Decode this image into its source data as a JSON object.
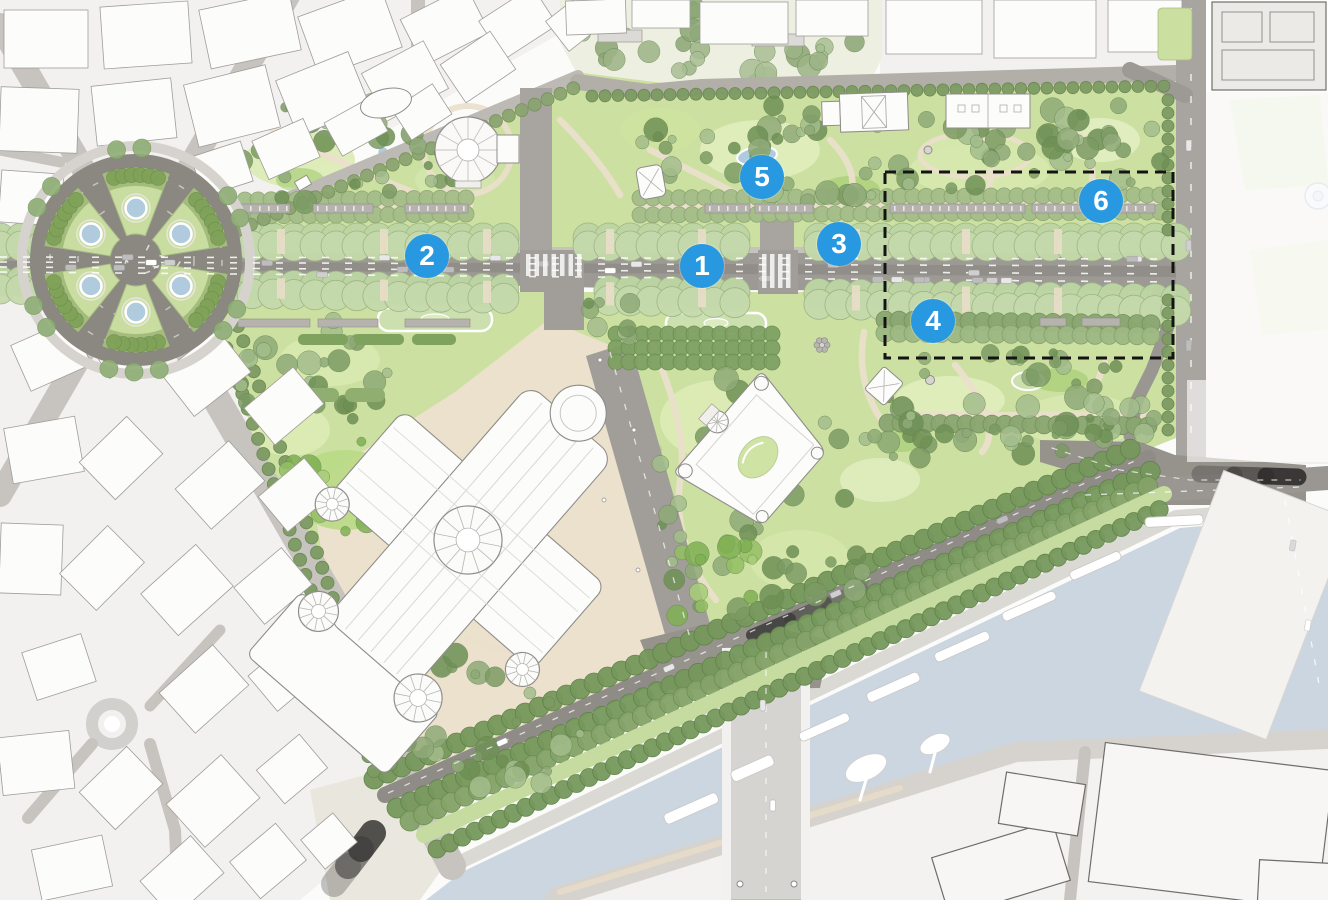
{
  "map": {
    "name": "Champs-Elysees gardens district site plan",
    "annotation_markers": [
      {
        "number": "1",
        "x": 702,
        "y": 266
      },
      {
        "number": "2",
        "x": 427,
        "y": 256
      },
      {
        "number": "3",
        "x": 839,
        "y": 244
      },
      {
        "number": "4",
        "x": 933,
        "y": 321
      },
      {
        "number": "5",
        "x": 762,
        "y": 177
      },
      {
        "number": "6",
        "x": 1101,
        "y": 201
      }
    ],
    "study_area_outline": {
      "x": 885,
      "y": 172,
      "width": 288,
      "height": 186
    },
    "colors": {
      "marker_fill": "#2899E1",
      "marker_text": "#FFFFFF",
      "outline": "#141414",
      "river": "#CBD6E1",
      "park_base": "#CCE0A1",
      "road": "#9D9A95",
      "city_road": "#C7C4C0",
      "city_block": "#F2F1EF",
      "building": "#FCFCFB",
      "path": "#EADFCB",
      "tree": "#8FAA78",
      "water_feature": "#AFCBDD",
      "quay": "#DBD9D4"
    }
  }
}
